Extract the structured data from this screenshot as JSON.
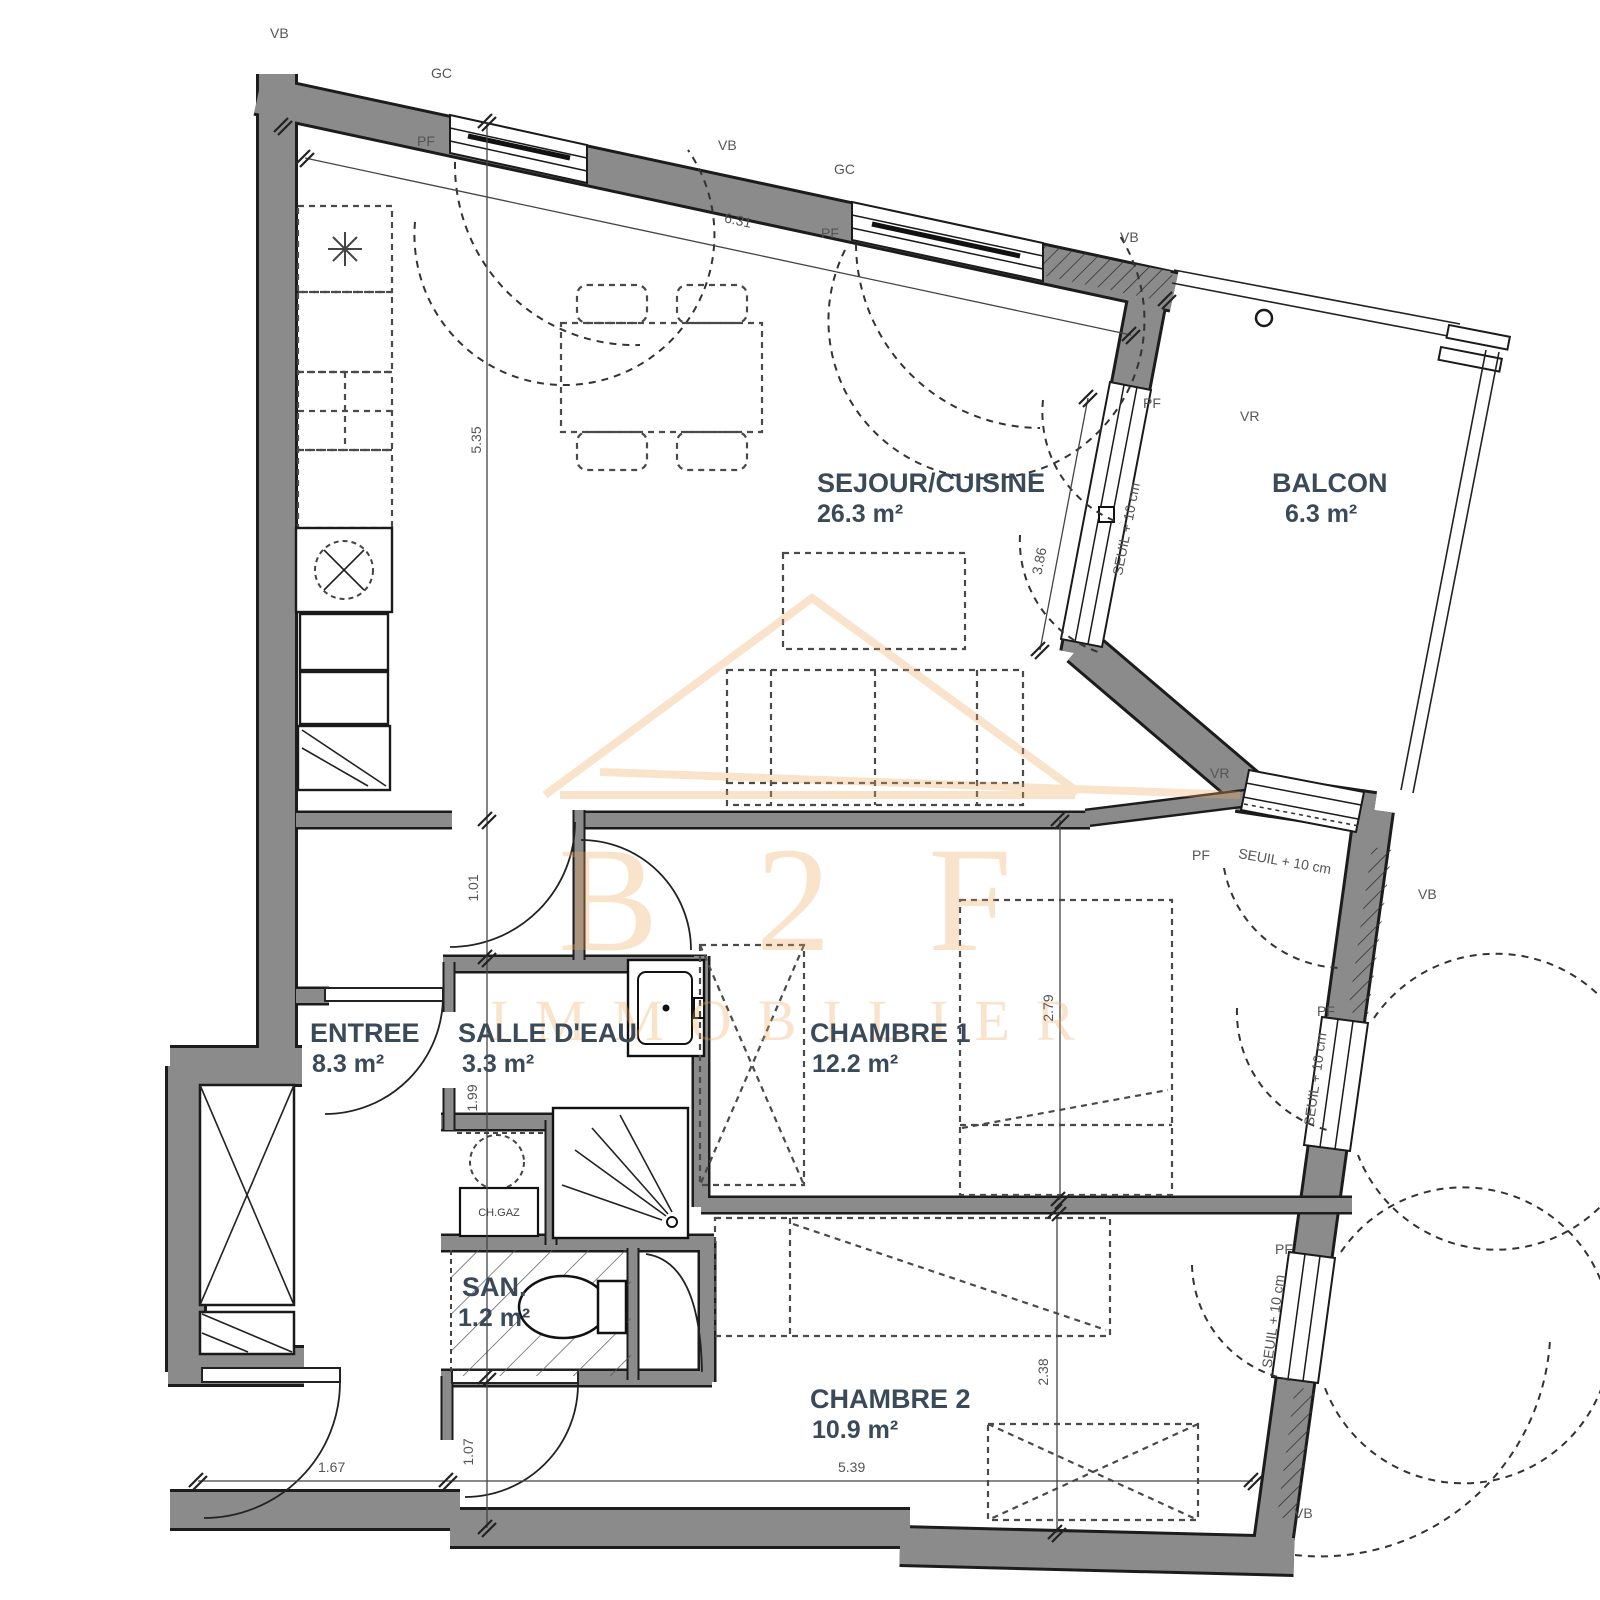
{
  "plan": {
    "type": "apartment-floor-plan",
    "watermark": {
      "line1": "B 2 F",
      "line2": "IMMOBILIER"
    },
    "colors": {
      "wall_fill": "#8b8b8b",
      "wall_edge": "#1c1c1c",
      "room_text": "#3a4a59",
      "annotation_text": "#555555",
      "watermark_orange": "#f0a95f"
    }
  },
  "rooms": [
    {
      "name": "SEJOUR/CUISINE",
      "area": "26.3 m²"
    },
    {
      "name": "BALCON",
      "area": "6.3 m²"
    },
    {
      "name": "ENTREE",
      "area": "8.3 m²"
    },
    {
      "name": "SALLE D'EAU",
      "area": "3.3 m²"
    },
    {
      "name": "CHAMBRE 1",
      "area": "12.2 m²"
    },
    {
      "name": "SAN.",
      "area": "1.2 m²"
    },
    {
      "name": "CHAMBRE 2",
      "area": "10.9 m²"
    }
  ],
  "annotations": [
    "VB",
    "GC",
    "PF",
    "VB",
    "GC",
    "PF",
    "VB",
    "VR",
    "PF",
    "SEUIL + 10 cm",
    "VR",
    "PF",
    "SEUIL + 10 cm",
    "VB",
    "PF",
    "SEUIL + 10 cm",
    "PF",
    "SEUIL + 10 cm",
    "VB",
    "CH.GAZ"
  ],
  "dimensions": [
    "6.31",
    "5.35",
    "1.01",
    "1.99",
    "1.07",
    "1.67",
    "5.39",
    "2.79",
    "2.38",
    "3.86"
  ]
}
